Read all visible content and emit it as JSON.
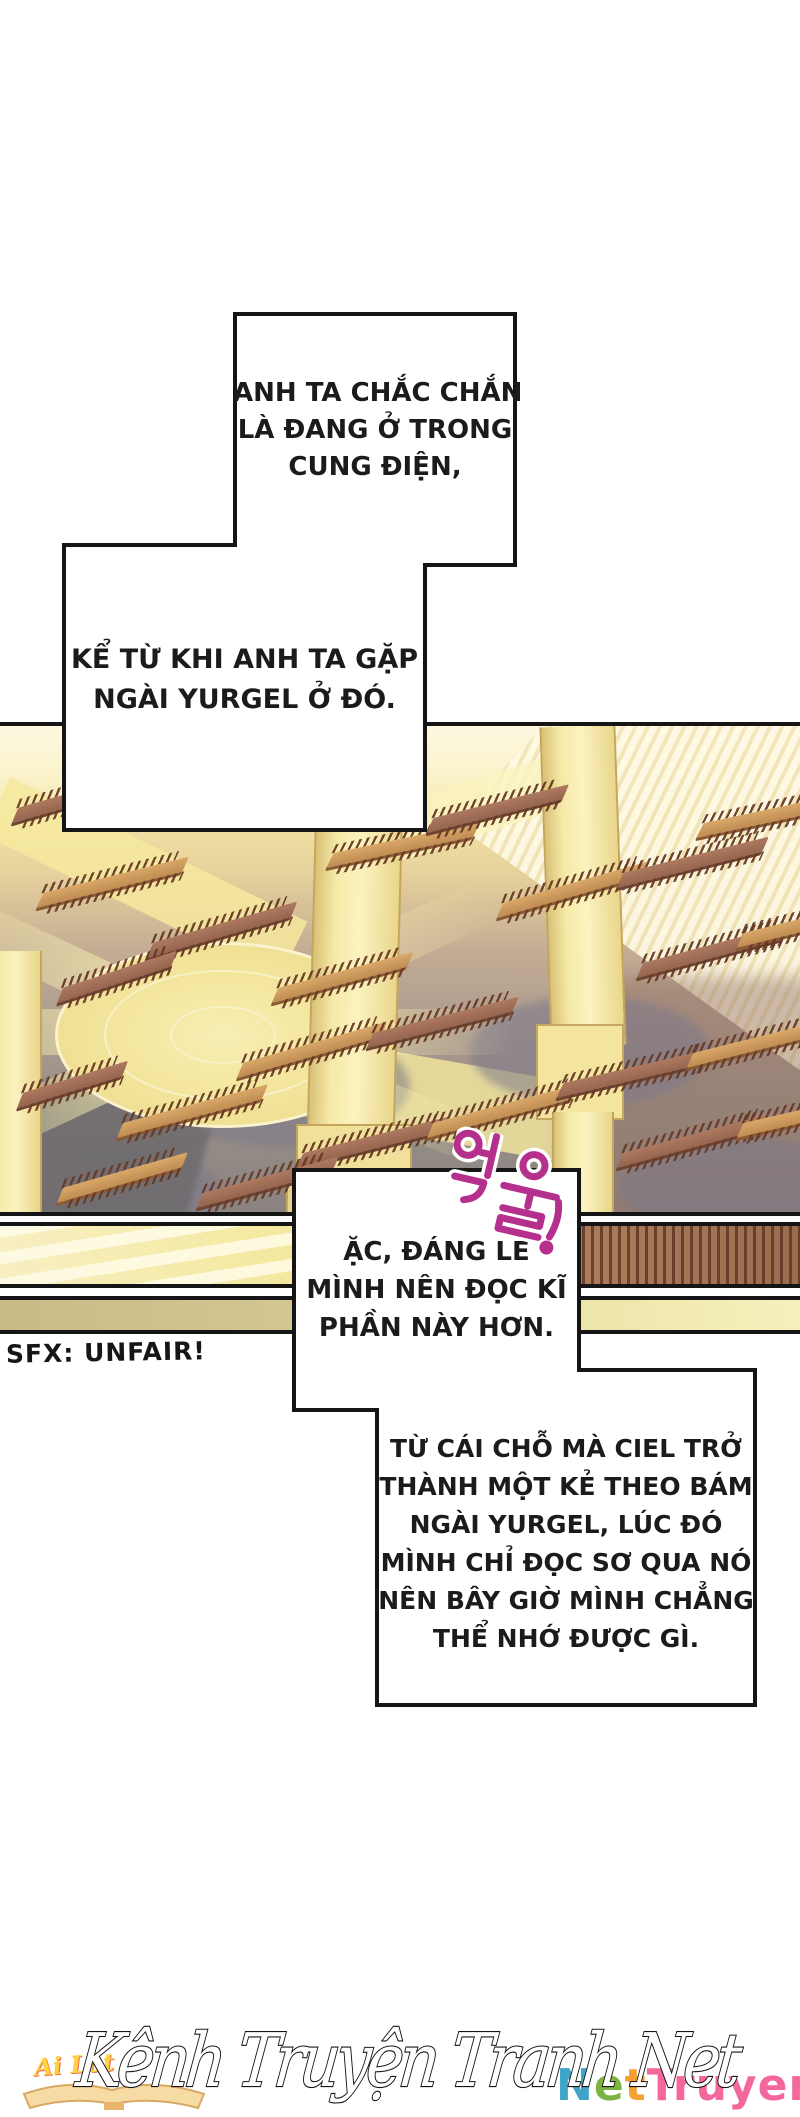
{
  "colors": {
    "ink": "#151515",
    "sfx_magenta": "#b5308d",
    "script_fill": "#ffffff"
  },
  "bubbles": {
    "b1": {
      "lines": [
        "ANH TA CHẮC CHẮN",
        "LÀ ĐANG Ở TRONG",
        "CUNG ĐIỆN,"
      ]
    },
    "b2": {
      "lines": [
        "KỂ TỪ KHI ANH TA GẶP",
        "NGÀI YURGEL Ở ĐÓ."
      ]
    },
    "b3": {
      "lines": [
        "ẶC, ĐÁNG LẼ",
        "MÌNH NÊN ĐỌC KĨ",
        "PHẦN NÀY HƠN."
      ]
    },
    "b4": {
      "lines": [
        "TỪ CÁI CHỖ MÀ CIEL TRỞ",
        "THÀNH MỘT KẺ THEO BÁM",
        "NGÀI YURGEL, LÚC ĐÓ",
        "MÌNH CHỈ ĐỌC SƠ QUA NÓ",
        "NÊN BÂY GIỜ MÌNH CHẲNG",
        "THỂ NHỚ ĐƯỢC GÌ."
      ]
    }
  },
  "sfx": {
    "korean": "억울!",
    "translation": "SFX: UNFAIR!"
  },
  "watermark": {
    "script": "Kênh Truyện Tranh Net",
    "small_script": "Ai Lót",
    "logo_parts": [
      {
        "t": "N",
        "c": "#3fa4c8"
      },
      {
        "t": "e",
        "c": "#7cb342"
      },
      {
        "t": "t",
        "c": "#f5a033"
      },
      {
        "t": "Truyen",
        "c": "#f4679d"
      }
    ]
  },
  "scene": {
    "tables": [
      [
        15,
        75,
        130,
        -16,
        1
      ],
      [
        40,
        160,
        150,
        -14,
        0
      ],
      [
        150,
        210,
        150,
        -16,
        1
      ],
      [
        275,
        255,
        140,
        -15,
        0
      ],
      [
        60,
        255,
        120,
        -18,
        1
      ],
      [
        330,
        120,
        150,
        -12,
        0
      ],
      [
        430,
        85,
        140,
        -14,
        1
      ],
      [
        500,
        170,
        150,
        -16,
        0
      ],
      [
        620,
        140,
        150,
        -14,
        1
      ],
      [
        700,
        90,
        120,
        -12,
        0
      ],
      [
        640,
        230,
        150,
        -15,
        1
      ],
      [
        740,
        200,
        120,
        -14,
        0
      ],
      [
        240,
        330,
        150,
        -16,
        0
      ],
      [
        370,
        300,
        150,
        -14,
        1
      ],
      [
        120,
        390,
        150,
        -15,
        0
      ],
      [
        20,
        360,
        110,
        -17,
        1
      ],
      [
        300,
        420,
        150,
        -14,
        1
      ],
      [
        430,
        390,
        150,
        -15,
        0
      ],
      [
        560,
        350,
        150,
        -13,
        1
      ],
      [
        690,
        320,
        140,
        -14,
        0
      ],
      [
        620,
        420,
        150,
        -15,
        1
      ],
      [
        740,
        390,
        110,
        -13,
        0
      ],
      [
        200,
        460,
        140,
        -15,
        1
      ],
      [
        60,
        455,
        130,
        -16,
        0
      ]
    ]
  }
}
